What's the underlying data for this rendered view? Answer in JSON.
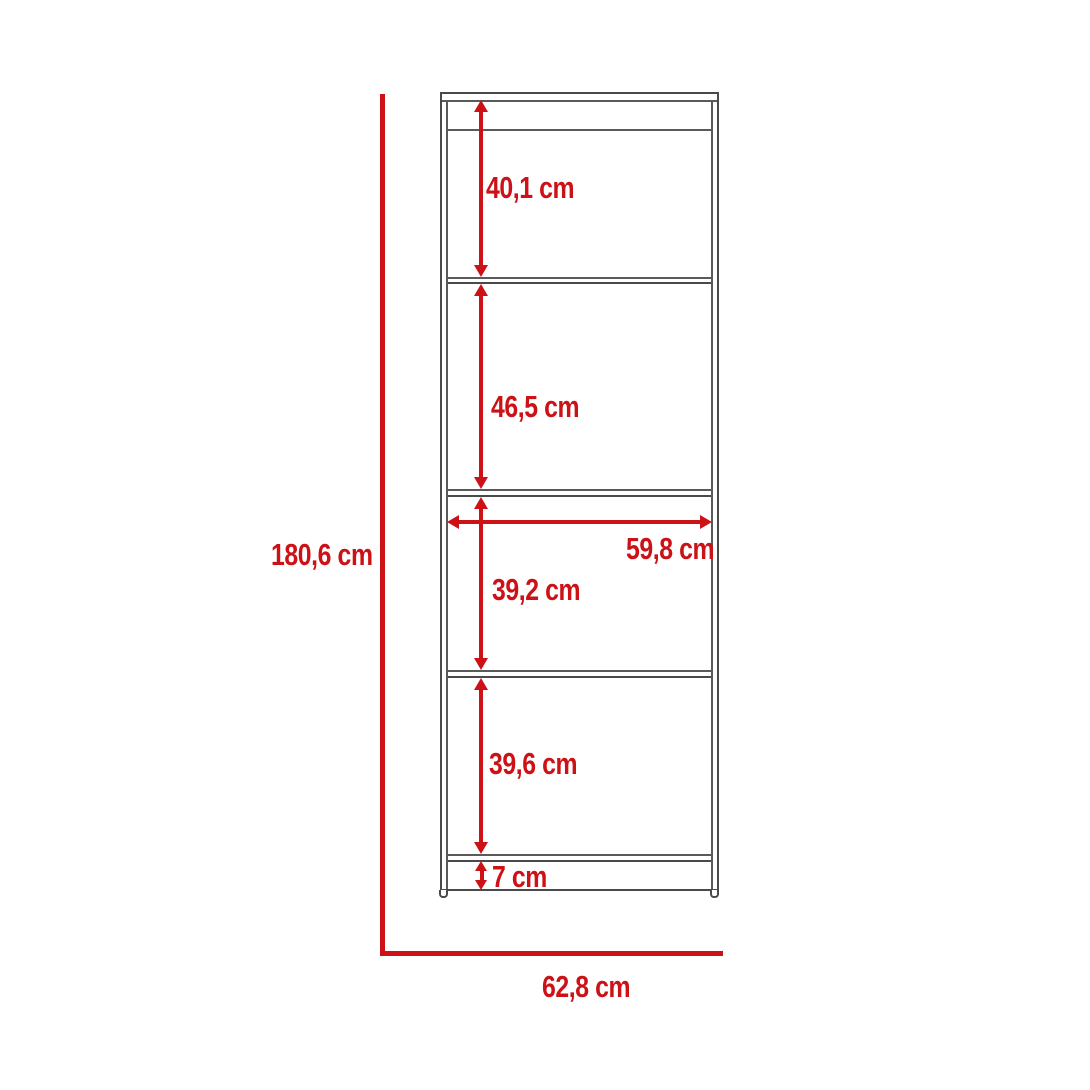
{
  "diagram": {
    "colors": {
      "dimension_red": "#cc1117",
      "outline_gray": "#4a4a4a",
      "background": "#ffffff"
    },
    "overall_height_label": "180,6 cm",
    "overall_width_label": "62,8 cm",
    "interior_width_label": "59,8 cm",
    "sections": [
      {
        "name": "top-shelf-space",
        "label": "40,1 cm"
      },
      {
        "name": "second-shelf-space",
        "label": "46,5 cm"
      },
      {
        "name": "third-shelf-space",
        "label": "39,2 cm"
      },
      {
        "name": "fourth-shelf-space",
        "label": "39,6 cm"
      },
      {
        "name": "plinth-height",
        "label": "7 cm"
      }
    ]
  }
}
